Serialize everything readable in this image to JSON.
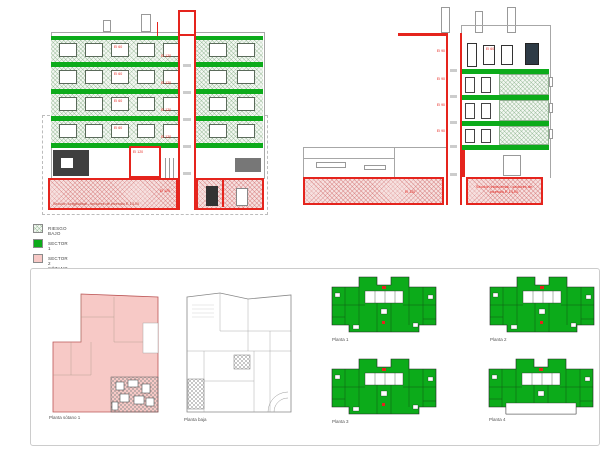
{
  "legend": {
    "items": [
      {
        "label": "RIESGO BAJO"
      },
      {
        "label": "SECTOR 1"
      },
      {
        "label": "SECTOR 2 SÓTANO"
      }
    ]
  },
  "sections": {
    "longitudinal": {
      "caption": "Sección longitudinal - sectores de incendio E 1/100",
      "core_label": "EI 120",
      "floor_label": "EI 60",
      "room_label": "EI 120",
      "basement_label": "EI 120"
    },
    "transversal": {
      "caption": "Sección transversal - sectores de incendio E 1/100",
      "story_label": "EI 90",
      "basement_label": "EI 120"
    }
  },
  "plans": {
    "items": [
      {
        "label": "Planta sótano 1"
      },
      {
        "label": "Planta baja"
      },
      {
        "label": "Planta 1"
      },
      {
        "label": "Planta 2"
      },
      {
        "label": "Planta 3"
      },
      {
        "label": "Planta 4",
        "setback": true
      }
    ]
  },
  "colors": {
    "sector_red": "#e5241d",
    "sector_green": "#0cab1a",
    "sector_pink": "#f7c9c6"
  }
}
